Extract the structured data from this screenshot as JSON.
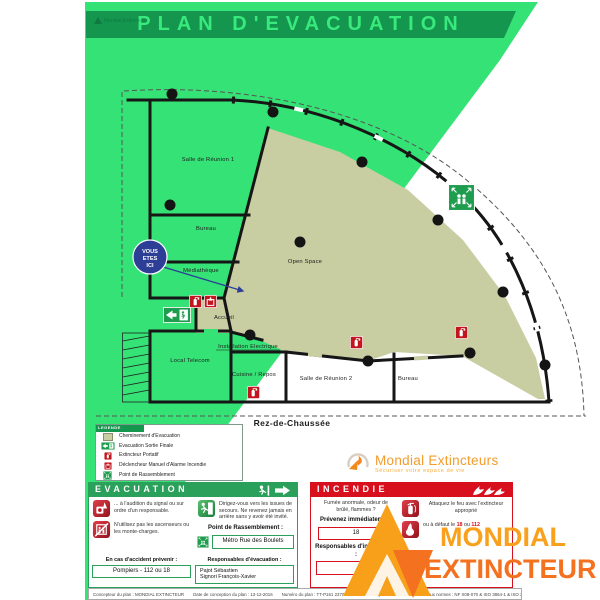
{
  "title": "PLAN D'EVACUATION",
  "brand": {
    "name": "Mondial Extincteurs",
    "tagline": "Sécuriser votre espace de vie"
  },
  "watermark": {
    "line1": "MONDIAL",
    "line2": "EXTINCTEUR"
  },
  "floor_label": "Rez-de-Chaussée",
  "you_are_here": {
    "lines": [
      "VOUS",
      "ETES",
      "ICI"
    ]
  },
  "plan": {
    "rooms": [
      {
        "label": "Salle de Réunion 1"
      },
      {
        "label": "Bureau"
      },
      {
        "label": "Médiathèque"
      },
      {
        "label": "Accueil"
      },
      {
        "label": "Local Telecom"
      },
      {
        "label": "Installation Electrique"
      },
      {
        "label": "Cuisine / Repos"
      },
      {
        "label": "Salle de Réunion 2"
      },
      {
        "label": "Bureau"
      },
      {
        "label": "Open Space"
      }
    ]
  },
  "legend": {
    "title": "LEGENDE",
    "items": [
      {
        "icon": "evacuation-path-swatch",
        "label": "Cheminement d'Evacuation"
      },
      {
        "icon": "exit-sign",
        "label": "Evacuation Sortie Finale"
      },
      {
        "icon": "extinguisher",
        "label": "Extincteur Portatif"
      },
      {
        "icon": "manual-alarm",
        "label": "Déclencheur Manuel d'Alarme Incendie"
      },
      {
        "icon": "assembly-point",
        "label": "Point de Rassemblement"
      }
    ]
  },
  "evacuation": {
    "header": "EVACUATION",
    "signal_text": "... à l'audition du signal ou sur ordre d'un responsable.",
    "elevator_text": "N'utilisez pas les ascenseurs ou les monte-charges.",
    "exit_text": "Dirigez-vous vers les issues de secours. Ne revenez jamais en arrière sans y avoir été invité.",
    "assembly_label": "Point de Rassemblement :",
    "assembly_value": "Métro Rue des Boulets",
    "accident_label": "En cas d'accident prévenir :",
    "accident_value": "Pompiers - 112 ou 18",
    "responsible_label": "Responsables d'évacuation :",
    "responsible_line1": "Pajot Sébastien",
    "responsible_line2": "Signori François-Xavier"
  },
  "incendie": {
    "header": "INCENDIE",
    "alert_text": "Fumée anormale, odeur de brûlé, flammes ?",
    "notify_text": "Prévenez immédiatement",
    "phone_value": "18",
    "attack_text": "Attaquez le feu avec l'extincteur approprié",
    "fallback_prefix": "ou à défaut le",
    "fallback_num1": "18",
    "fallback_mid": "ou",
    "fallback_num2": "112",
    "responsible_label": "Responsables d'intervention :",
    "responsible_value": ""
  },
  "footer": {
    "items": [
      "Concepteur du plan : MONDIAL EXTINCTEUR",
      "Date de conception du plan : 13-12-2016",
      "Numéro du plan : TT-P161 23700-101",
      "Mise à jour N° : 1",
      "Conforme aux normes : NF X08-070 & ISO 3864-1 & ISO 3864-3"
    ]
  },
  "colors": {
    "bright_green": "#35E275",
    "dark_green": "#15964F",
    "red": "#D8101E",
    "beige_path": "#C8CDA2",
    "orange": "#F9A11D",
    "orange_dark": "#F4711F",
    "blue_marker": "#2D3E96"
  }
}
